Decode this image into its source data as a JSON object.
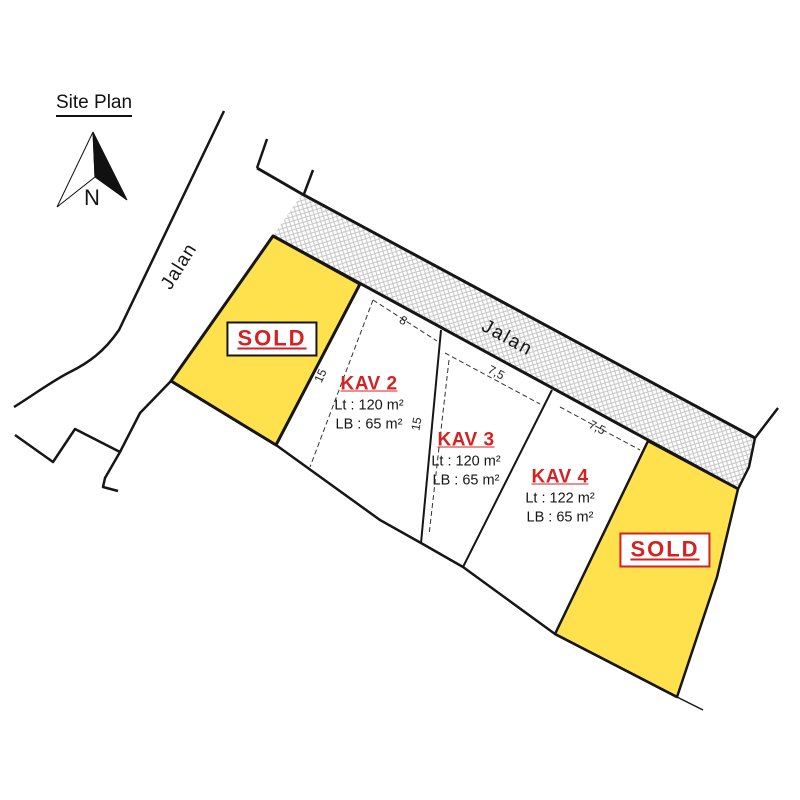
{
  "title": "Site Plan",
  "compass": {
    "label": "N"
  },
  "roads": {
    "left": "Jalan",
    "top": "Jalan"
  },
  "plots": {
    "sold_left": {
      "label": "SOLD",
      "status": "sold"
    },
    "sold_right": {
      "label": "SOLD",
      "status": "sold"
    },
    "kav2": {
      "name": "KAV 2",
      "lt": "Lt : 120 m²",
      "lb": "LB : 65 m²"
    },
    "kav3": {
      "name": "KAV 3",
      "lt": "Lt : 120 m²",
      "lb": "LB : 65 m²"
    },
    "kav4": {
      "name": "KAV 4",
      "lt": "Lt : 122 m²",
      "lb": "LB : 65 m²"
    }
  },
  "dimensions": {
    "kav2_frontage": "8",
    "kav2_depth": "15",
    "kav3_frontage": "7,5",
    "kav3_depth": "15",
    "kav4_frontage": "7,5"
  },
  "colors": {
    "sold_fill": "#ffe04d",
    "accent_red": "#d42222",
    "line_black": "#161616",
    "hatch_gray": "#c6c6c6"
  }
}
